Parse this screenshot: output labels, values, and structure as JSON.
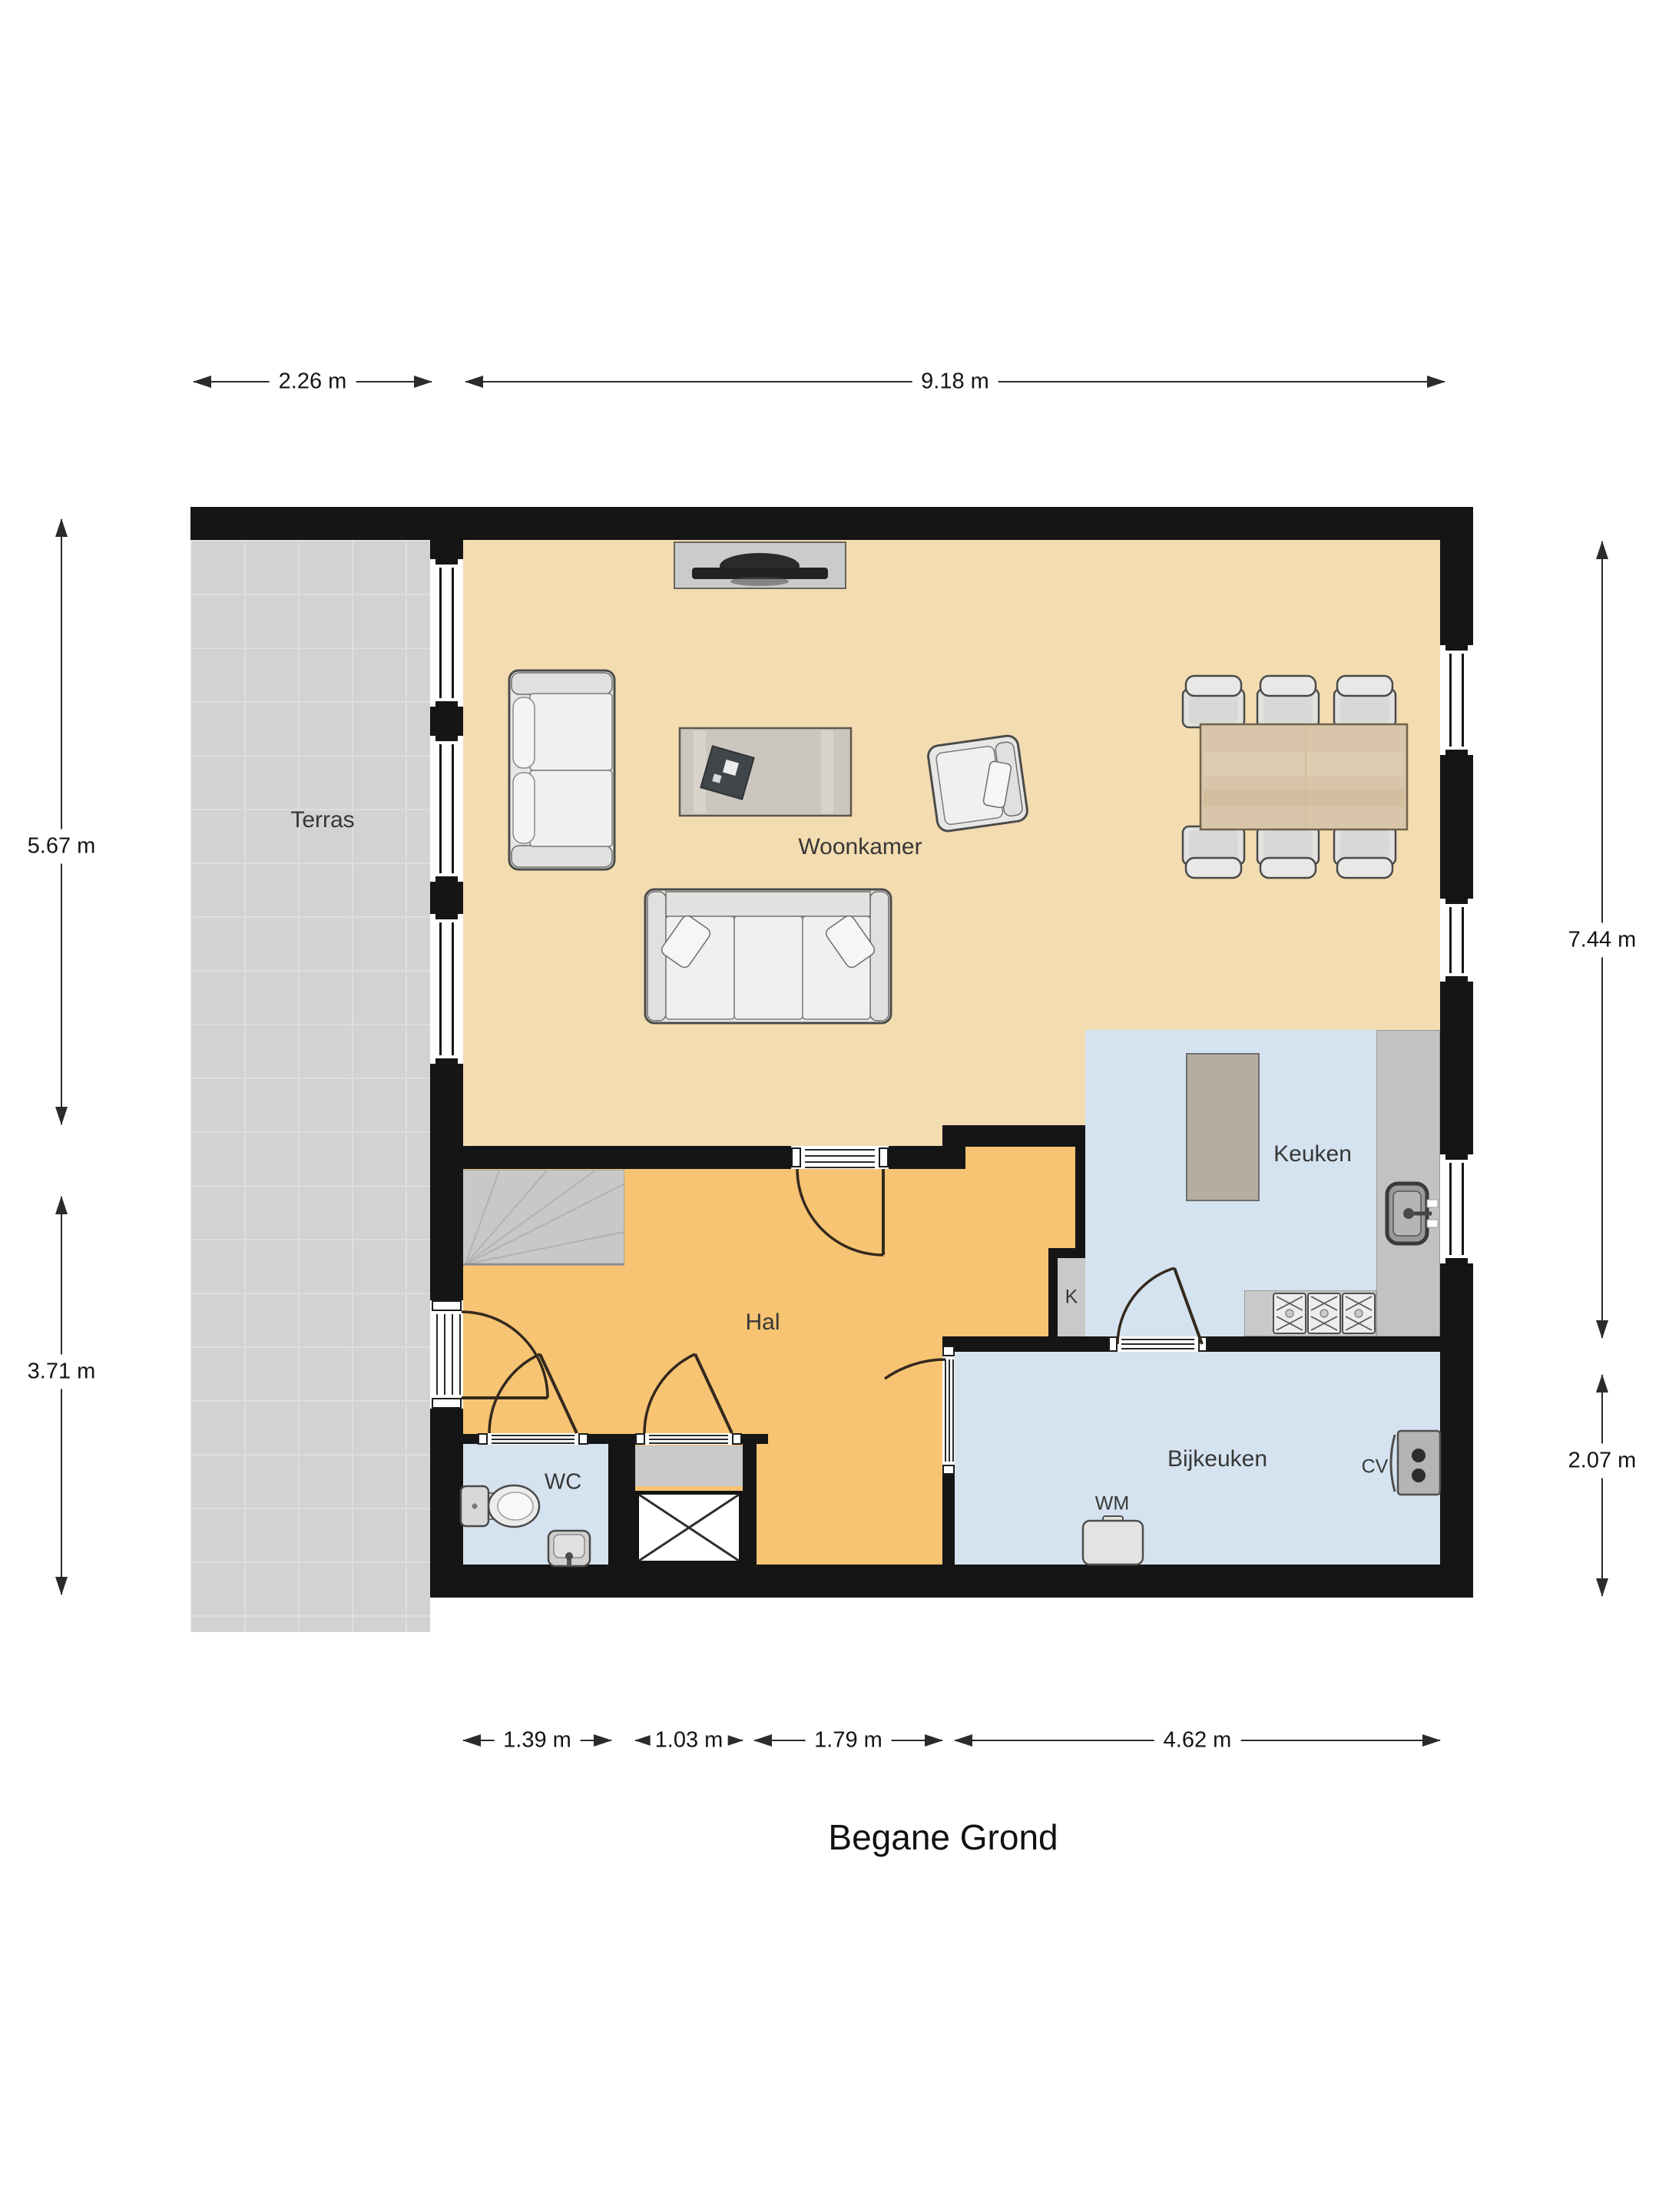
{
  "title": "Begane Grond",
  "rooms": {
    "terras": "Terras",
    "woonkamer": "Woonkamer",
    "keuken": "Keuken",
    "hal": "Hal",
    "wc": "WC",
    "bijkeuken": "Bijkeuken",
    "closet": "K",
    "washer": "WM",
    "boiler": "CV"
  },
  "dimensions": {
    "top": [
      "2.26 m",
      "9.18 m"
    ],
    "bottom": [
      "1.39 m",
      "1.03 m",
      "1.79 m",
      "4.62 m"
    ],
    "left": [
      "5.67 m",
      "3.71 m"
    ],
    "right": [
      "7.44 m",
      "2.07 m"
    ]
  },
  "colors": {
    "wall": "#151515",
    "woonkamer_floor": "#f4dcb1",
    "hal_floor": "#f7c473",
    "wet_room_floor": "#d5e3f0",
    "terras_floor": "#d2d2d2",
    "terras_grid": "#dedede",
    "furniture_gray": "#c9c9c9",
    "counter_gray": "#c2c2c2",
    "island_taupe": "#b5ad9f",
    "table_wood": "#d9c5a9",
    "dimension_line": "#2b2b2b"
  }
}
